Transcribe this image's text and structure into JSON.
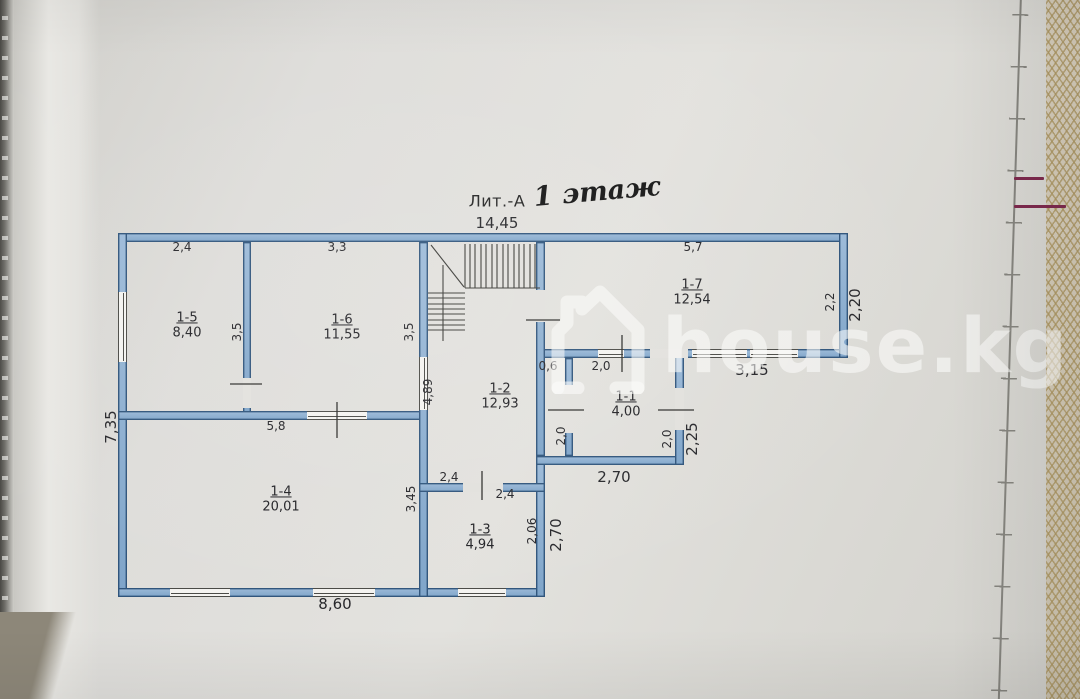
{
  "title": {
    "litera": "Лит.-А",
    "handwritten_floor": "1 этаж"
  },
  "watermark": {
    "text": "house.kg"
  },
  "rooms": {
    "r1": {
      "number": "1-1",
      "area": "4,00"
    },
    "r2": {
      "number": "1-2",
      "area": "12,93"
    },
    "r3": {
      "number": "1-3",
      "area": "4,94"
    },
    "r4": {
      "number": "1-4",
      "area": "20,01"
    },
    "r5": {
      "number": "1-5",
      "area": "8,40"
    },
    "r6": {
      "number": "1-6",
      "area": "11,55"
    },
    "r7": {
      "number": "1-7",
      "area": "12,54"
    }
  },
  "dims": {
    "total_width": "14,45",
    "r5_top": "2,4",
    "r6_top": "3,3",
    "r7_top": "5,7",
    "r5_right": "3,5",
    "r6_right": "3,5",
    "r7_right_inner": "2,2",
    "r7_right_outer": "2,20",
    "corridor_top": "0,6",
    "r1_top": "2,0",
    "r7_bottom": "3,15",
    "r2_left": "4,89",
    "r1_left": "2,0",
    "r1_right_inner": "2,0",
    "r1_right_outer": "2,25",
    "r1_bottom": "2,70",
    "r4_top": "5,8",
    "r2_bottom_upper": "2,4",
    "r2_bottom_lower": "2,4",
    "r4_right": "3,45",
    "r3_right_inner": "2,06",
    "r3_right_outer": "2,70",
    "bottom_width": "8,60",
    "left_height": "7,35"
  },
  "colors": {
    "wall_fill": "#8fb2d4",
    "wall_edge": "#2f547b",
    "paper": "#e0dfdb",
    "watermark": "#fbfbf9",
    "red_pen": "#7e2a4e",
    "lace": "#ab9560"
  }
}
